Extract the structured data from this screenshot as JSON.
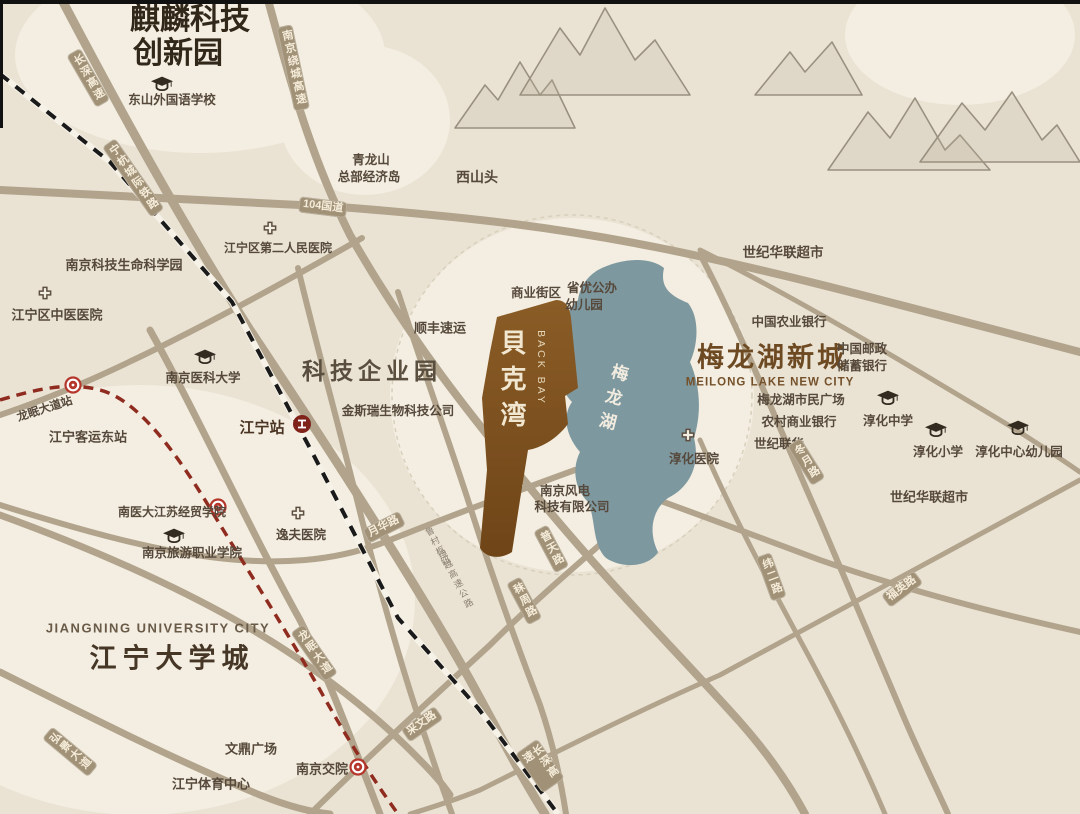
{
  "map": {
    "project": {
      "name_cn": "貝克湾",
      "name_en": "BACK BAY"
    },
    "colors": {
      "background": "#eae3d4",
      "light_zone": "#f3eee1",
      "road": "#b2a48c",
      "road_label_bg": "#a09177",
      "lake": "#7e98a0",
      "project_fill": "#7e4f1d",
      "metro_line": "#8f2b1f",
      "railway_line": "#1a1a1a",
      "poi_text": "#56493b",
      "title_brown": "#6e4a23"
    },
    "labels": [
      {
        "id": "label-qilin-park-line1",
        "text": "麒麟科技",
        "x": 190,
        "y": 20,
        "s": 30,
        "cls": "big-dark"
      },
      {
        "id": "label-qilin-park-line2",
        "text": "创新园",
        "x": 178,
        "y": 54,
        "s": 30,
        "cls": "big-dark"
      },
      {
        "id": "label-tech-enterprise-park",
        "text": "科技企业园",
        "x": 372,
        "y": 371,
        "s": 23,
        "cls": "big-gray"
      },
      {
        "id": "label-meilong-new-city-cn",
        "text": "梅龙湖新城",
        "x": 772,
        "y": 358,
        "s": 27,
        "cls": "big-brown"
      },
      {
        "id": "label-meilong-new-city-en",
        "text": "MEILONG LAKE NEW CITY",
        "x": 770,
        "y": 383,
        "s": 11.5,
        "cls": "sub-brown"
      },
      {
        "id": "label-jiangning-university-city-cn",
        "text": "江宁大学城",
        "x": 172,
        "y": 659,
        "s": 27,
        "cls": "big-dark2"
      },
      {
        "id": "label-jiangning-university-city-en",
        "text": "JIANGNING UNIVERSITY CITY",
        "x": 158,
        "y": 629,
        "s": 13,
        "cls": "sub-gray"
      },
      {
        "id": "label-backbay-cn",
        "text": "貝克湾",
        "x": 511,
        "y": 383,
        "s": 26,
        "cls": "backbay-cn"
      },
      {
        "id": "label-backbay-en",
        "text": "BACK BAY",
        "x": 541,
        "y": 368,
        "s": 10.5,
        "cls": "backbay-en"
      },
      {
        "id": "label-meilong-lake",
        "text": "梅龙湖",
        "x": 611,
        "y": 400,
        "s": 17,
        "r": 14,
        "cls": "lake-label"
      },
      {
        "id": "label-dongshan-foreign-school",
        "text": "东山外国语学校",
        "x": 172,
        "y": 100
      },
      {
        "id": "label-qinglongshan-line1",
        "text": "青龙山",
        "x": 371,
        "y": 160
      },
      {
        "id": "label-qinglongshan-line2",
        "text": "总部经济岛",
        "x": 369,
        "y": 177
      },
      {
        "id": "label-xishantou",
        "text": "西山头",
        "x": 477,
        "y": 177,
        "s": 14
      },
      {
        "id": "label-shiji-hualian-north",
        "text": "世纪华联超市",
        "x": 783,
        "y": 253,
        "s": 13.5
      },
      {
        "id": "label-jiangning-2nd-hospital",
        "text": "江宁区第二人民医院",
        "x": 278,
        "y": 249,
        "s": 12
      },
      {
        "id": "label-life-science-park",
        "text": "南京科技生命科学园",
        "x": 124,
        "y": 266,
        "s": 13
      },
      {
        "id": "label-tcm-hospital",
        "text": "江宁区中医医院",
        "x": 57,
        "y": 316,
        "s": 13
      },
      {
        "id": "label-nanjing-medical-univ",
        "text": "南京医科大学",
        "x": 203,
        "y": 378
      },
      {
        "id": "label-longmian-avenue-station",
        "text": "龙眠大道站",
        "x": 45,
        "y": 410,
        "s": 11.5,
        "r": -18
      },
      {
        "id": "label-jiangning-east-bus-station",
        "text": "江宁客运东站",
        "x": 88,
        "y": 438,
        "s": 13
      },
      {
        "id": "label-jiangning-railway-station",
        "text": "江宁站",
        "x": 262,
        "y": 428,
        "s": 15,
        "cls": "station-bold"
      },
      {
        "id": "label-genscript",
        "text": "金斯瑞生物科技公司",
        "x": 398,
        "y": 411
      },
      {
        "id": "label-sf-express",
        "text": "顺丰速运",
        "x": 440,
        "y": 329,
        "s": 13
      },
      {
        "id": "label-commercial-block",
        "text": "商业街区",
        "x": 536,
        "y": 293
      },
      {
        "id": "label-kindergarten-line1",
        "text": "省优公办",
        "x": 592,
        "y": 288
      },
      {
        "id": "label-kindergarten-line2",
        "text": "幼儿园",
        "x": 584,
        "y": 305
      },
      {
        "id": "label-agri-bank",
        "text": "中国农业银行",
        "x": 789,
        "y": 322
      },
      {
        "id": "label-postal-bank-line1",
        "text": "中国邮政",
        "x": 862,
        "y": 349
      },
      {
        "id": "label-postal-bank-line2",
        "text": "储蓄银行",
        "x": 862,
        "y": 366
      },
      {
        "id": "label-citizen-plaza",
        "text": "梅龙湖市民广场",
        "x": 801,
        "y": 400
      },
      {
        "id": "label-rural-bank",
        "text": "农村商业银行",
        "x": 799,
        "y": 422
      },
      {
        "id": "label-century-lianhua",
        "text": "世纪联华",
        "x": 779,
        "y": 444
      },
      {
        "id": "label-chunhua-hospital",
        "text": "淳化医院",
        "x": 694,
        "y": 459
      },
      {
        "id": "label-chunhua-middle-school",
        "text": "淳化中学",
        "x": 888,
        "y": 421
      },
      {
        "id": "label-chunhua-primary-school",
        "text": "淳化小学",
        "x": 938,
        "y": 452
      },
      {
        "id": "label-chunhua-kindergarten",
        "text": "淳化中心幼儿园",
        "x": 1019,
        "y": 452
      },
      {
        "id": "label-shiji-hualian-east",
        "text": "世纪华联超市",
        "x": 929,
        "y": 498,
        "s": 13
      },
      {
        "id": "label-wind-power-line1",
        "text": "南京风电",
        "x": 565,
        "y": 491
      },
      {
        "id": "label-wind-power-line2",
        "text": "科技有限公司",
        "x": 572,
        "y": 507
      },
      {
        "id": "label-nymu-jsjm-college",
        "text": "南医大江苏经贸学院",
        "x": 172,
        "y": 513,
        "s": 12
      },
      {
        "id": "label-yifu-hospital",
        "text": "逸夫医院",
        "x": 301,
        "y": 535
      },
      {
        "id": "label-tourism-college",
        "text": "南京旅游职业学院",
        "x": 192,
        "y": 553
      },
      {
        "id": "label-wending-plaza",
        "text": "文鼎广场",
        "x": 251,
        "y": 750,
        "s": 13
      },
      {
        "id": "label-jiangning-sports-center",
        "text": "江宁体育中心",
        "x": 211,
        "y": 785,
        "s": 13
      },
      {
        "id": "label-nanjing-jiaoyuan",
        "text": "南京交院",
        "x": 322,
        "y": 770,
        "s": 13
      }
    ],
    "road_labels": [
      {
        "id": "road-changshen-expwy-north",
        "text": "长深高速",
        "x": 88,
        "y": 78,
        "r": -30,
        "v": true
      },
      {
        "id": "road-raocheng-expwy",
        "text": "南京绕城高速",
        "x": 293,
        "y": 68,
        "r": -12,
        "v": true
      },
      {
        "id": "rail-ninghang-line",
        "text": "宁杭城际铁路",
        "x": 133,
        "y": 178,
        "r": -35,
        "v": true
      },
      {
        "id": "road-g104",
        "text": "104国道",
        "x": 323,
        "y": 207,
        "r": 7,
        "v": false
      },
      {
        "id": "road-yuehua-road",
        "text": "月华路",
        "x": 384,
        "y": 527,
        "r": -27,
        "v": false
      },
      {
        "id": "road-longmian-avenue",
        "text": "龙眠大道",
        "x": 314,
        "y": 653,
        "r": -35,
        "v": true
      },
      {
        "id": "road-hongjing-avenue",
        "text": "弘景大道",
        "x": 70,
        "y": 752,
        "r": -50,
        "v": true
      },
      {
        "id": "road-caiwen-road",
        "text": "采文路",
        "x": 422,
        "y": 724,
        "r": -35,
        "v": false
      },
      {
        "id": "road-changshen-expwy-south",
        "text": "长深高速",
        "x": 540,
        "y": 766,
        "r": -35,
        "v": true
      },
      {
        "id": "road-putian-road",
        "text": "普天路",
        "x": 551,
        "y": 549,
        "r": -28,
        "v": true
      },
      {
        "id": "road-mozhou-road",
        "text": "秣周路",
        "x": 524,
        "y": 601,
        "r": -28,
        "v": true
      },
      {
        "id": "road-weier-road",
        "text": "纬二路",
        "x": 771,
        "y": 577,
        "r": -20,
        "v": true
      },
      {
        "id": "road-fuying-road",
        "text": "福英路",
        "x": 902,
        "y": 589,
        "r": -37,
        "v": false
      },
      {
        "id": "road-dongyue-road",
        "text": "冬月路",
        "x": 806,
        "y": 462,
        "r": -32,
        "v": true
      }
    ],
    "tiny_labels": [
      {
        "id": "tiny-lucun-junction",
        "text": "鲁村枢纽",
        "x": 437,
        "y": 547,
        "r": -28
      },
      {
        "id": "tiny-raoyue-expwy",
        "text": "绕越高速公路",
        "x": 455,
        "y": 580,
        "r": -28
      }
    ],
    "icons": [
      {
        "id": "grad-cap-icon",
        "x": 162,
        "y": 84
      },
      {
        "id": "grad-cap-icon",
        "x": 205,
        "y": 357
      },
      {
        "id": "grad-cap-icon",
        "x": 174,
        "y": 536
      },
      {
        "id": "grad-cap-icon",
        "x": 888,
        "y": 398
      },
      {
        "id": "grad-cap-icon",
        "x": 936,
        "y": 430
      },
      {
        "id": "grad-cap-icon",
        "x": 1018,
        "y": 428
      },
      {
        "id": "hospital-cross-icon",
        "x": 270,
        "y": 228
      },
      {
        "id": "hospital-cross-icon",
        "x": 45,
        "y": 293
      },
      {
        "id": "hospital-cross-icon",
        "x": 688,
        "y": 435
      },
      {
        "id": "hospital-cross-icon",
        "x": 298,
        "y": 513
      },
      {
        "id": "metro-station-icon",
        "x": 73,
        "y": 385
      },
      {
        "id": "metro-station-icon",
        "x": 218,
        "y": 507
      },
      {
        "id": "metro-station-icon",
        "x": 358,
        "y": 767
      },
      {
        "id": "railway-station-icon",
        "x": 302,
        "y": 424
      }
    ]
  }
}
